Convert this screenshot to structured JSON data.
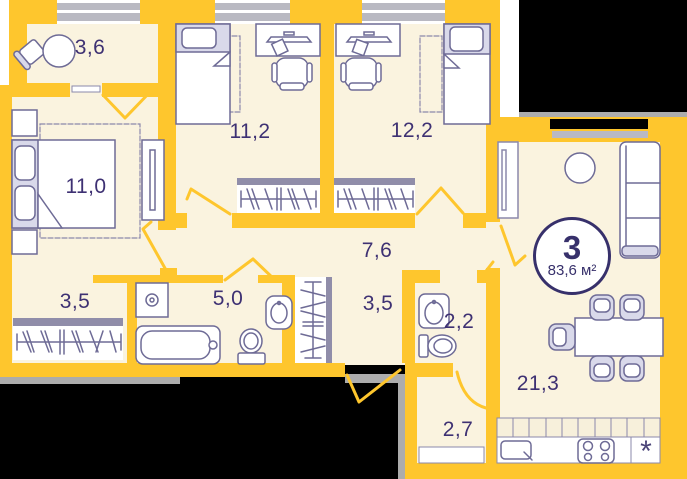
{
  "badge": {
    "rooms_count": "3",
    "total_area": "83,6 м²"
  },
  "rooms": {
    "balcony": {
      "area": "3,6"
    },
    "bedroom1": {
      "area": "11,0"
    },
    "bedroom2": {
      "area": "11,2"
    },
    "bedroom3": {
      "area": "12,2"
    },
    "hallway": {
      "area": "7,6"
    },
    "closet": {
      "area": "3,5"
    },
    "bathroom": {
      "area": "5,0"
    },
    "hall2": {
      "area": "3,5"
    },
    "wc": {
      "area": "2,2"
    },
    "kitchen_living": {
      "area": "21,3"
    },
    "pantry": {
      "area": "2,7"
    }
  },
  "symbols": {
    "fridge": "*"
  },
  "colors": {
    "wall": "#FEC62D",
    "floor": "#FAF3DF",
    "furniture_outline": "#6E6B96",
    "text": "#3E3173",
    "window_bar": "#B9B9C2",
    "void": "#000000"
  }
}
